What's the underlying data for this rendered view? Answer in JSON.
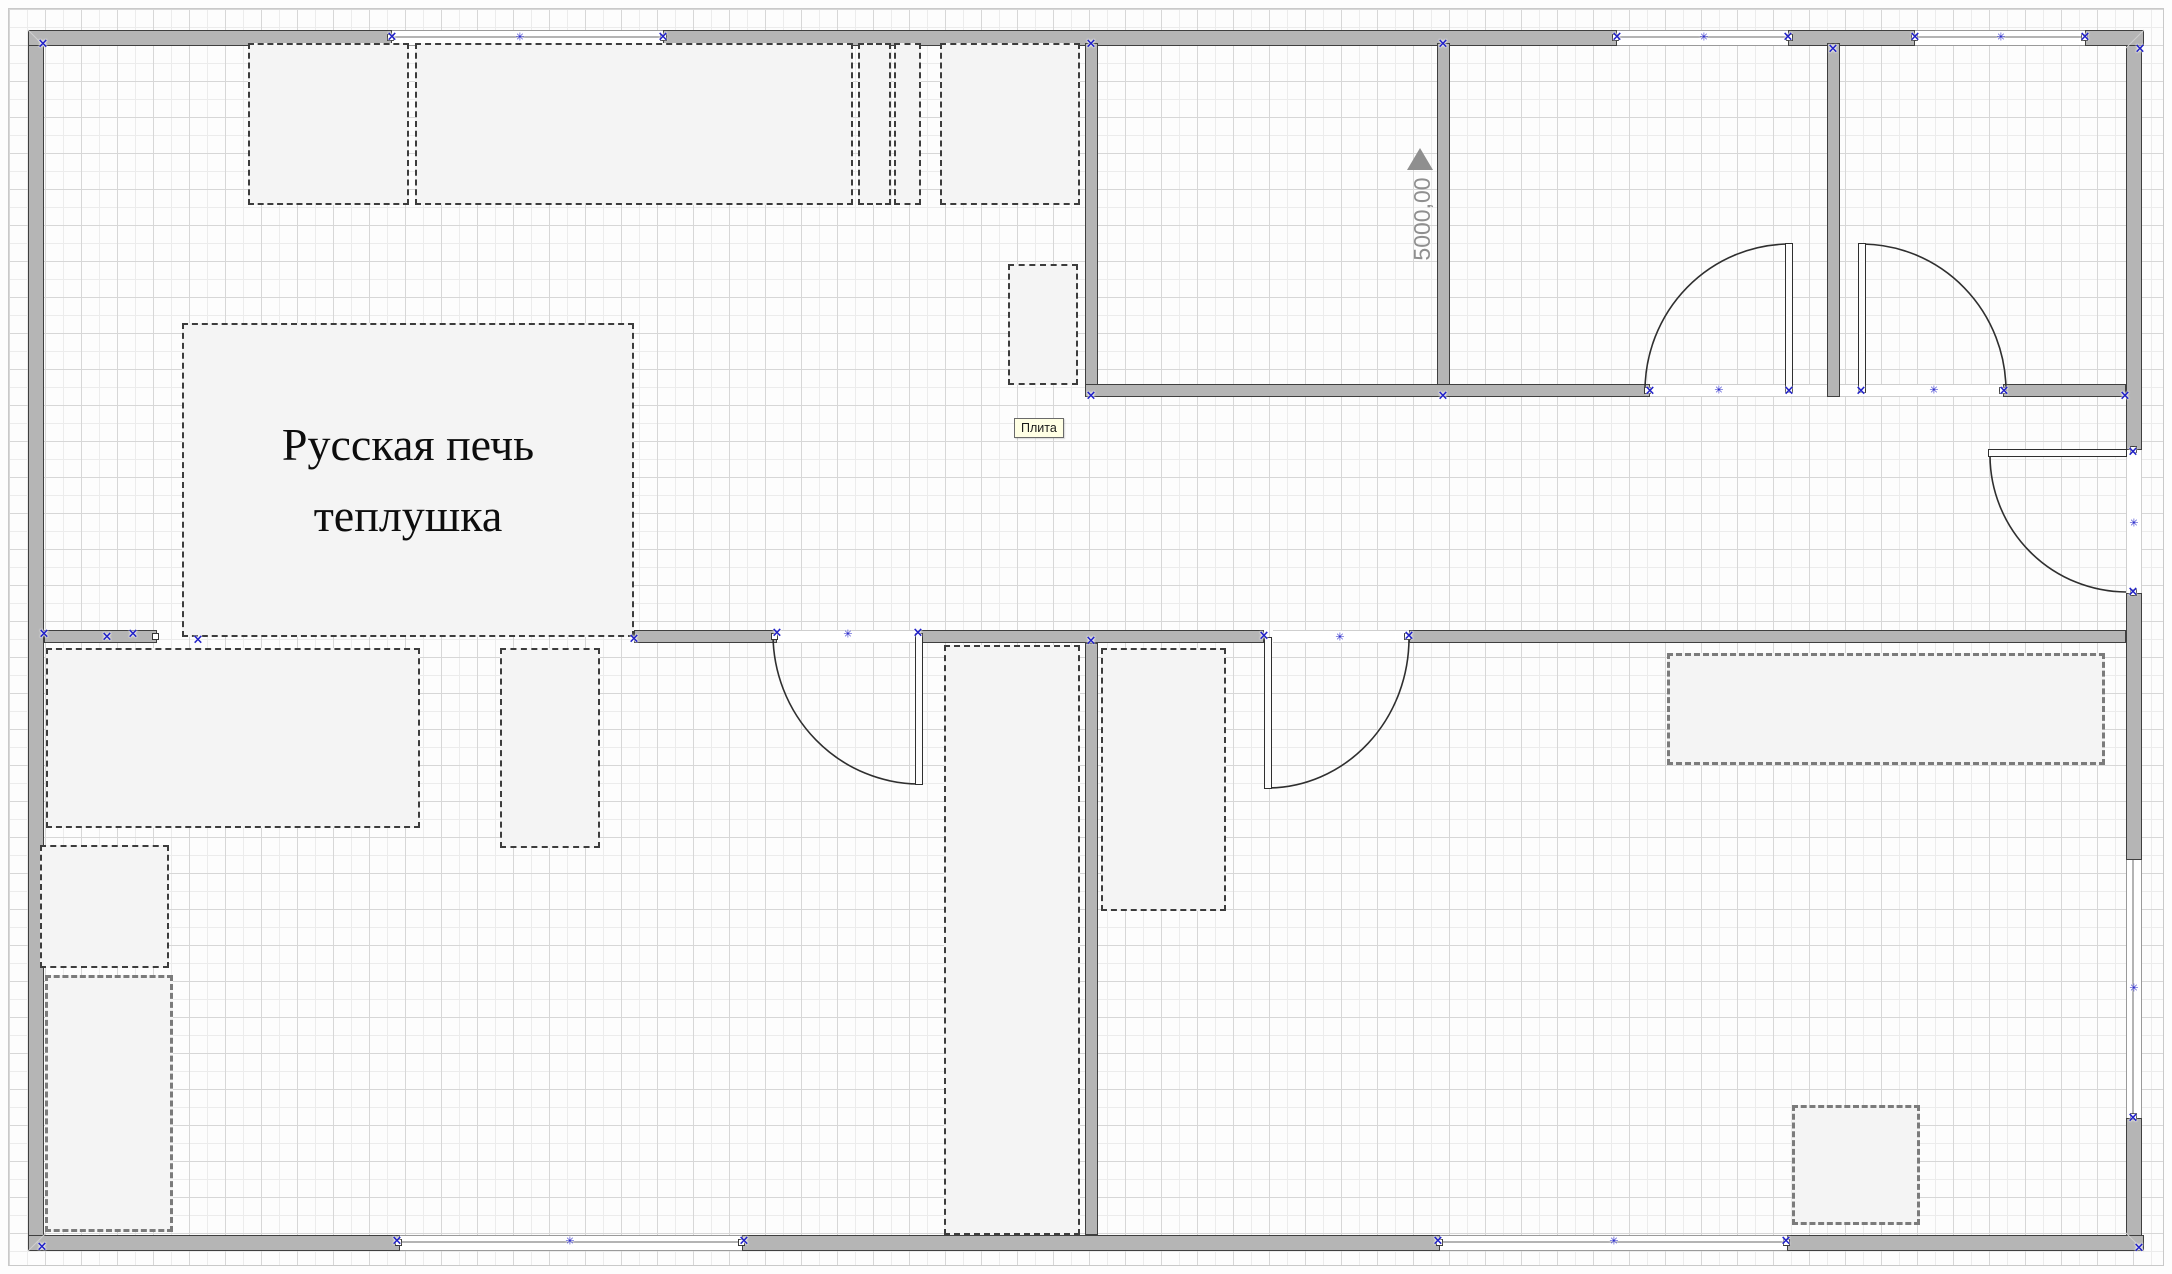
{
  "drawing": {
    "kind": "floor-plan",
    "stove": {
      "line1": "Русская печь",
      "line2": "теплушка"
    },
    "plita": {
      "label": "Плита"
    },
    "dimension": {
      "value": "5000,00",
      "direction": "up"
    }
  },
  "colors": {
    "canvas_bg": "#fdfdfd",
    "wall_fill": "#b5b5b5",
    "wall_edge": "#3f3f3f",
    "fixture_fill": "#f4f4f4",
    "dash_dark": "#3c3c3c",
    "dash_gray": "#7b7b7b",
    "marker_blue": "#2121c8",
    "dimension_gray": "#8f8f8f",
    "label_bg": "#ffffe4",
    "grid_major": "#d7d7d7",
    "grid_minor": "#ececec"
  },
  "icons": {
    "connection_x": "×",
    "connection_star": "✳",
    "dimension_arrow": "up-triangle"
  }
}
